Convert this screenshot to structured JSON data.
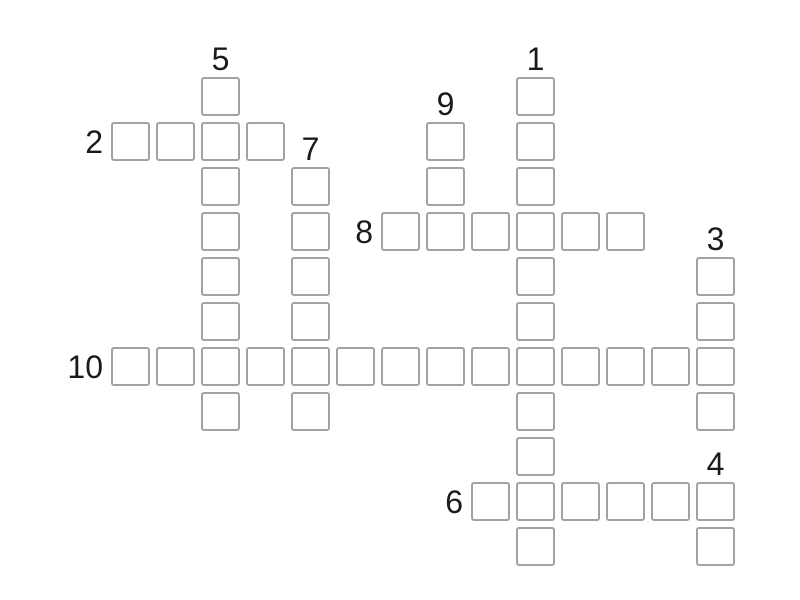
{
  "page": {
    "background": "#ffffff"
  },
  "theme": {
    "cell_border_color": "#a2a2a2",
    "cell_fill": "#ffffff",
    "label_color": "#1a1a1a"
  },
  "puzzle": {
    "type": "crossword",
    "all_cells_empty": true,
    "entries": [
      {
        "number": "5",
        "direction": "down",
        "col": 3,
        "row": 1,
        "length": 8
      },
      {
        "number": "1",
        "direction": "down",
        "col": 10,
        "row": 1,
        "length": 11
      },
      {
        "number": "2",
        "direction": "across",
        "col": 1,
        "row": 2,
        "length": 4
      },
      {
        "number": "9",
        "direction": "down",
        "col": 8,
        "row": 2,
        "length": 3
      },
      {
        "number": "7",
        "direction": "down",
        "col": 5,
        "row": 3,
        "length": 6
      },
      {
        "number": "8",
        "direction": "across",
        "col": 7,
        "row": 4,
        "length": 6
      },
      {
        "number": "3",
        "direction": "down",
        "col": 14,
        "row": 5,
        "length": 4
      },
      {
        "number": "10",
        "direction": "across",
        "col": 1,
        "row": 7,
        "length": 14
      },
      {
        "number": "6",
        "direction": "across",
        "col": 9,
        "row": 10,
        "length": 6
      },
      {
        "number": "4",
        "direction": "down",
        "col": 14,
        "row": 10,
        "length": 2
      }
    ]
  }
}
